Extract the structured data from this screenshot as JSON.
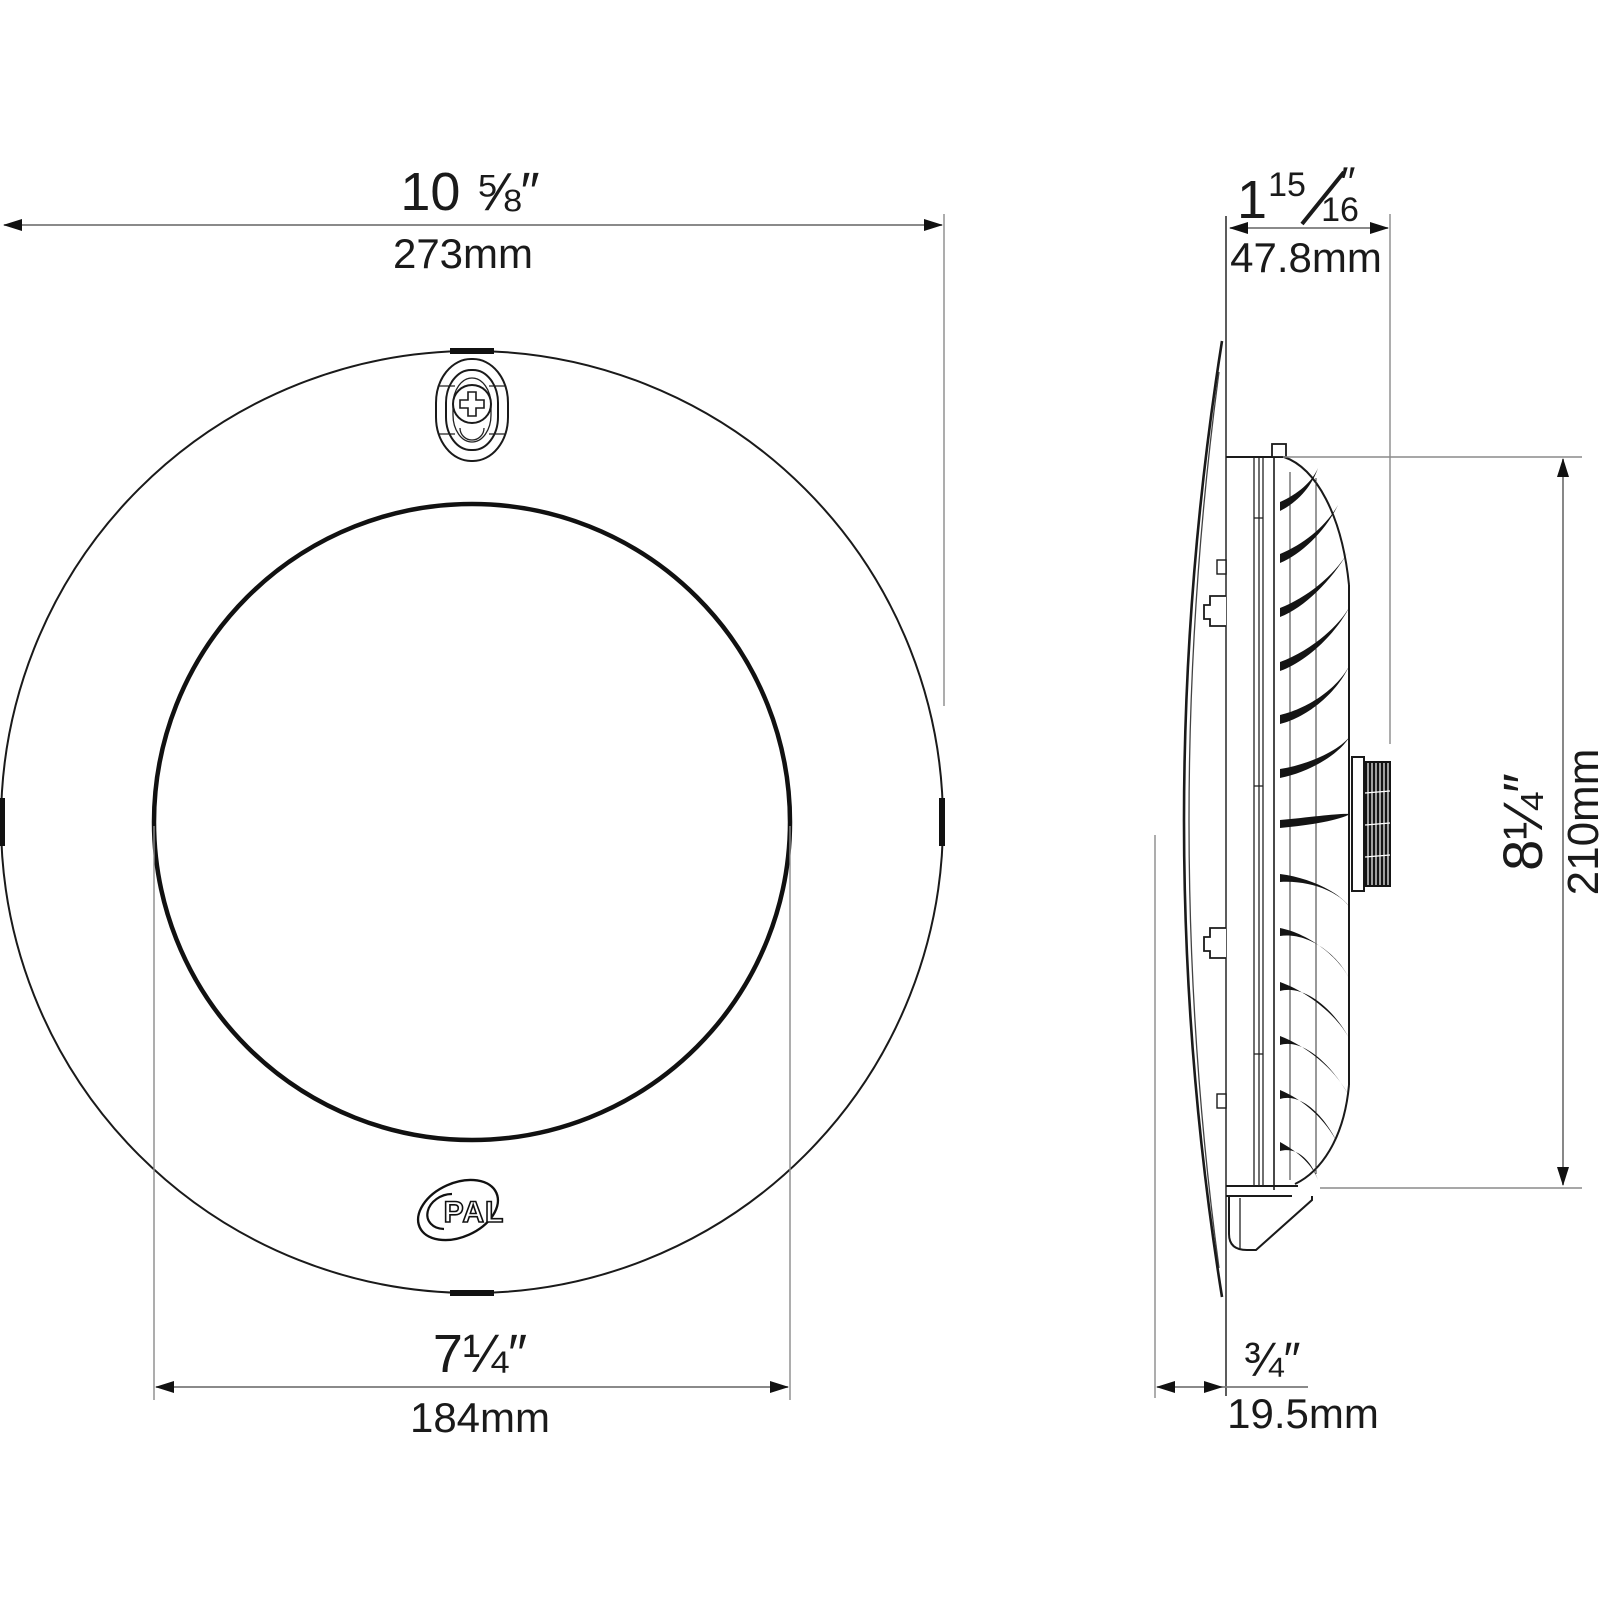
{
  "front_view": {
    "outer_diameter": {
      "inches": "10 ⅝″",
      "mm": "273mm"
    },
    "lens_diameter": {
      "inches": "7¼″",
      "mm": "184mm"
    },
    "logo": "PAL"
  },
  "side_view": {
    "depth": {
      "whole": "1",
      "num": "15",
      "den": "16",
      "unit_mark": "″",
      "mm": "47.8mm"
    },
    "body_height": {
      "inches": "8¼″",
      "mm": "210mm"
    },
    "lens_protrusion": {
      "inches": "¾″",
      "mm": "19.5mm"
    }
  }
}
